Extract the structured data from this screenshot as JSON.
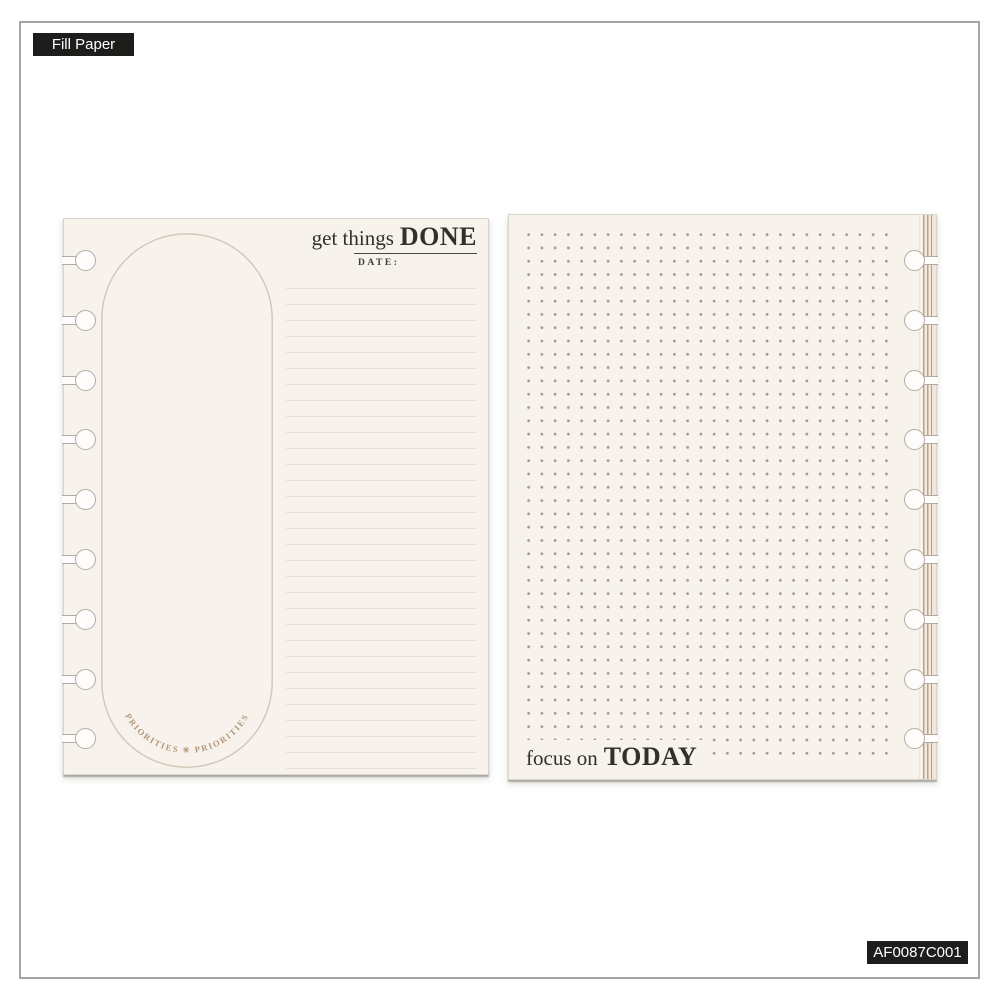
{
  "badges": {
    "product_type": "Fill Paper",
    "sku": "AF0087C001"
  },
  "left_page": {
    "title_prefix": "get things",
    "title_emphasis": "DONE",
    "date_label": "DATE:",
    "priorities_arc_text": "PRIORITIES  ✳  PRIORITIES",
    "disc_hole_count": 9
  },
  "right_page": {
    "footer_prefix": "focus on",
    "footer_emphasis": "TODAY",
    "disc_hole_count": 9
  },
  "colors": {
    "paper": "#f7f3ec",
    "badge_background": "#1d1d1b",
    "badge_text": "#ffffff",
    "frame_border": "#a5a5a5",
    "oval_stroke": "#d2c5b6",
    "arc_text": "#b2977a",
    "ruled_line": "#e7e0d5",
    "dot_grid": "#a3988a",
    "ink": "#33302c",
    "stack_edge_tan": "#c89e73",
    "punch_outline": "#b2ada4"
  }
}
